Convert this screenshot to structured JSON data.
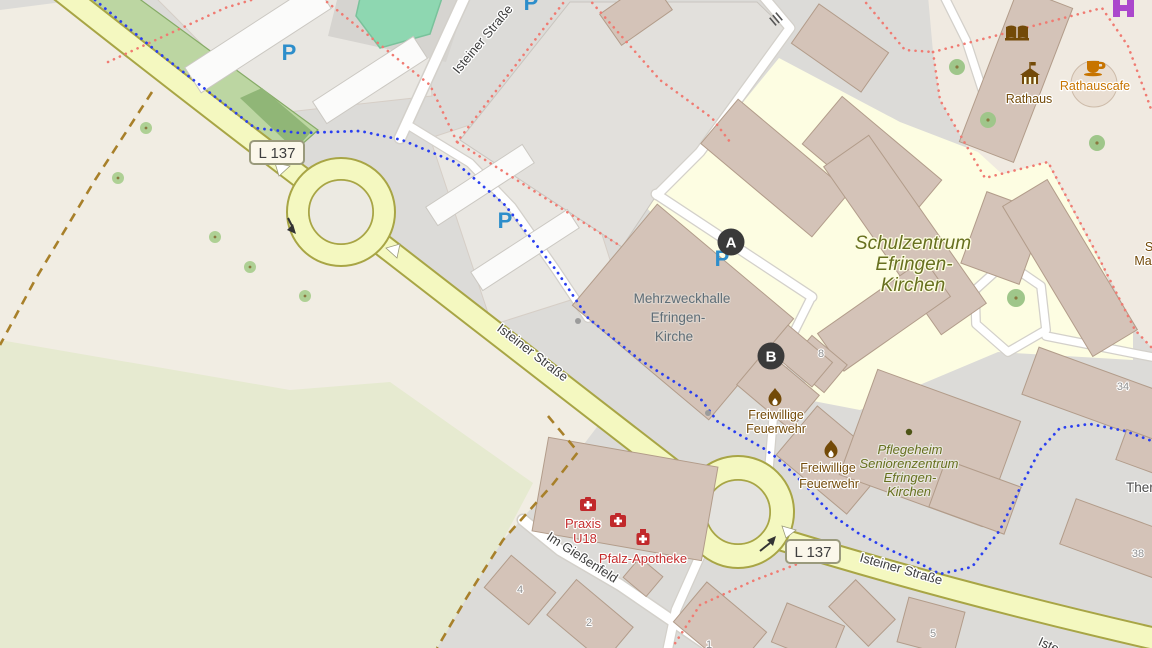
{
  "map": {
    "markers": {
      "a": "A",
      "b": "B"
    },
    "road_badges": {
      "l137_top": "L 137",
      "l137_bottom": "L 137"
    },
    "streets": {
      "isteiner_top": "Isteiner Straße",
      "isteiner_mid": "Isteiner Straße",
      "isteiner_bottom": "Isteiner Straße",
      "isteiner_partial": "Iste",
      "im_giessenfeld": "Im Gießenfeld"
    },
    "labels": {
      "schulzentrum": {
        "lines": [
          "Schulzentrum",
          "Efringen-",
          "Kirchen"
        ]
      },
      "mehrzweckhalle": {
        "lines": [
          "Mehrzweckhalle",
          "Efringen-",
          "Kirche"
        ]
      },
      "feuerwehr_nord": {
        "lines": [
          "Freiwillige",
          "Feuerwehr"
        ]
      },
      "feuerwehr_sued": {
        "lines": [
          "Freiwillige",
          "Feuerwehr"
        ]
      },
      "pflegeheim": {
        "lines": [
          "Pflegeheim",
          "Seniorenzentrum",
          "Efringen-",
          "Kirchen"
        ]
      },
      "praxis": {
        "lines": [
          "Praxis",
          "U18"
        ]
      },
      "pfalz_apotheke": "Pfalz-Apotheke",
      "rathaus": "Rathaus",
      "rathauscafe": "Rathauscafe",
      "therme_partial": "Ther",
      "edge_partial_top": "S",
      "edge_partial_bottom": "Ma"
    },
    "house_numbers": {
      "h8": "8",
      "h34": "34",
      "h38": "38",
      "h5": "5",
      "h4": "4",
      "h2": "2",
      "h1": "1"
    },
    "parking_symbol": "P",
    "colors": {
      "road_yellow": "#f4f8c0",
      "road_casing": "#a8a545",
      "school_area": "#fdfde2",
      "building": "#d4c3b8",
      "pitch": "#8ed7b1",
      "path_blue": "#2a3ff0",
      "boundary_red": "#f07b72",
      "boundary_brown": "#a8802a",
      "poi_brown": "#734a08",
      "poi_red": "#c42d2d",
      "poi_orange": "#c77400",
      "marker_bg": "#3a3a3a"
    }
  }
}
